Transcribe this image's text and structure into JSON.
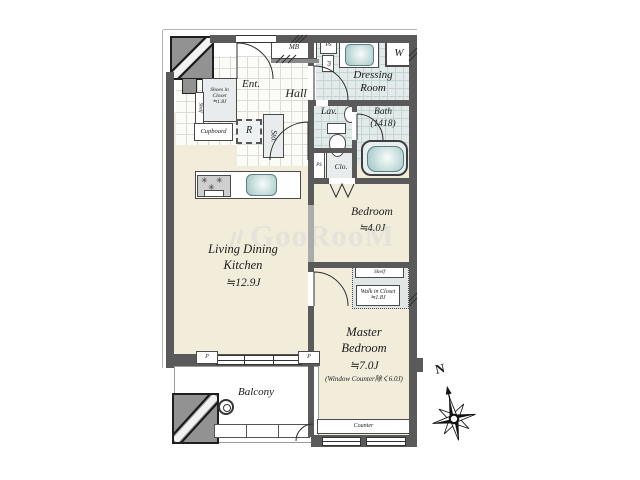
{
  "watermark": {
    "text": "GooRooM"
  },
  "compass": {
    "north": "N"
  },
  "colors": {
    "wall": "#5a5a5a",
    "floor_beige": "#f2ecdb",
    "wet_tile": "#e3ebea",
    "hall_tile": "#fbfbf7",
    "fixture_teal": "#9cc3c2",
    "watermark_gray": "#e7e5de"
  },
  "rooms": {
    "ldk": {
      "line1": "Living Dining",
      "line2": "Kitchen",
      "size": "≒12.9J"
    },
    "bedroom": {
      "name": "Bedroom",
      "size": "≒4.0J"
    },
    "master": {
      "line1": "Master",
      "line2": "Bedroom",
      "size": "≒7.0J",
      "note": "(Window Counter除く6.0J)"
    },
    "balcony": {
      "name": "Balcony"
    },
    "hall": {
      "name": "Hall"
    },
    "entrance": {
      "name": "Ent."
    },
    "dressing": {
      "line1": "Dressing",
      "line2": "Room"
    },
    "lavatory": {
      "name": "Lav."
    },
    "bath": {
      "line1": "Bath",
      "line2": "(1418)"
    }
  },
  "storage": {
    "shoes_closet": {
      "line1": "Shoes in",
      "line2": "Closet",
      "line3": "≒1.8J",
      "shelf": "Shelf"
    },
    "cupboard": "Cupboard",
    "refrigerator": "R",
    "storage": "Sto.",
    "closet": "Clo.",
    "walk_in_closet": {
      "shelf": "Shelf",
      "line1": "Walk in Closet",
      "line2": "≒1.8J"
    }
  },
  "service": {
    "mb": "MB",
    "ps_top": "PS",
    "ps_shaft": "PS",
    "ps_lower": "PS",
    "washer": "W",
    "counter": "Counter",
    "pillar_left": "P",
    "pillar_right": "P"
  },
  "icons": {
    "stove_burner": "✳"
  }
}
